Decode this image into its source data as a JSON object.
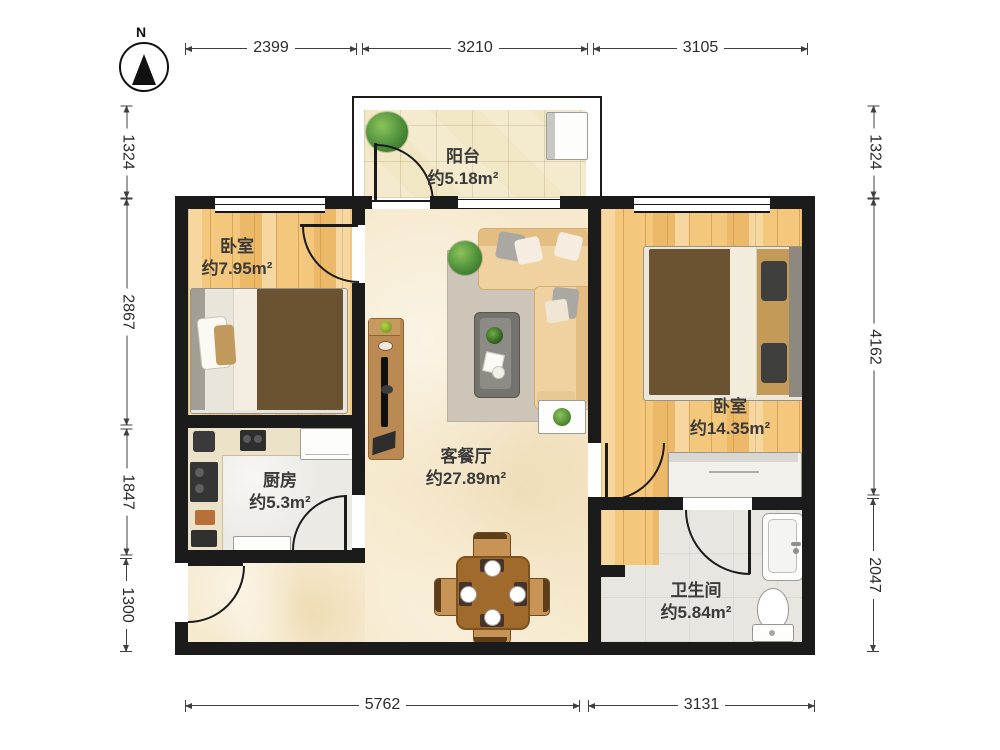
{
  "compass": {
    "label": "N"
  },
  "rooms": [
    {
      "id": "balcony",
      "name": "阳台",
      "area": "约5.18m²"
    },
    {
      "id": "bedroom_small",
      "name": "卧室",
      "area": "约7.95m²"
    },
    {
      "id": "kitchen",
      "name": "厨房",
      "area": "约5.3m²"
    },
    {
      "id": "living_dining",
      "name": "客餐厅",
      "area": "约27.89m²"
    },
    {
      "id": "bedroom_large",
      "name": "卧室",
      "area": "约14.35m²"
    },
    {
      "id": "bathroom",
      "name": "卫生间",
      "area": "约5.84m²"
    }
  ],
  "dimensions_mm": {
    "top": [
      "2399",
      "3210",
      "3105"
    ],
    "bottom": [
      "5762",
      "3131"
    ],
    "left": [
      "1324",
      "2867",
      "1847",
      "1300"
    ],
    "right": [
      "1324",
      "4162",
      "2047"
    ]
  },
  "colors": {
    "wall": "#1b1b1b",
    "wood_floor": "#f3c87c",
    "marble_floor": "#f6e9cd",
    "grey_floor": "#eceae5",
    "balcony_tile": "#f1e7c5",
    "bed_blanket": "#6b5332",
    "sofa": "#ecca92",
    "dining_wood": "#a06a2c",
    "plant_green": "#4e8f3a"
  }
}
